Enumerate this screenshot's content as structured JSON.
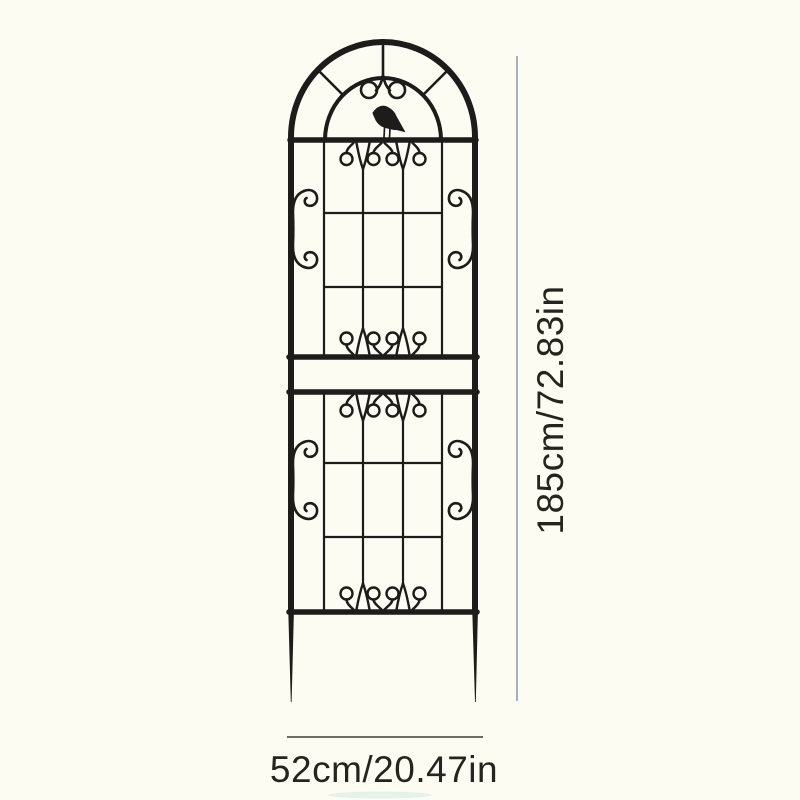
{
  "diagram": {
    "subject": "garden-trellis-with-bird",
    "dimensions": {
      "height_label": "185cm/72.83in",
      "width_label": "52cm/20.47in"
    }
  },
  "colors": {
    "background": "#fdfcf2",
    "trellis": "#1d1c1a",
    "height_line": "#a3b2ba",
    "width_line": "#3c3b36",
    "label_text": "#26241f",
    "ground_shadow": "#c8e6df"
  },
  "icons": {
    "bird": "bird-silhouette-icon"
  }
}
